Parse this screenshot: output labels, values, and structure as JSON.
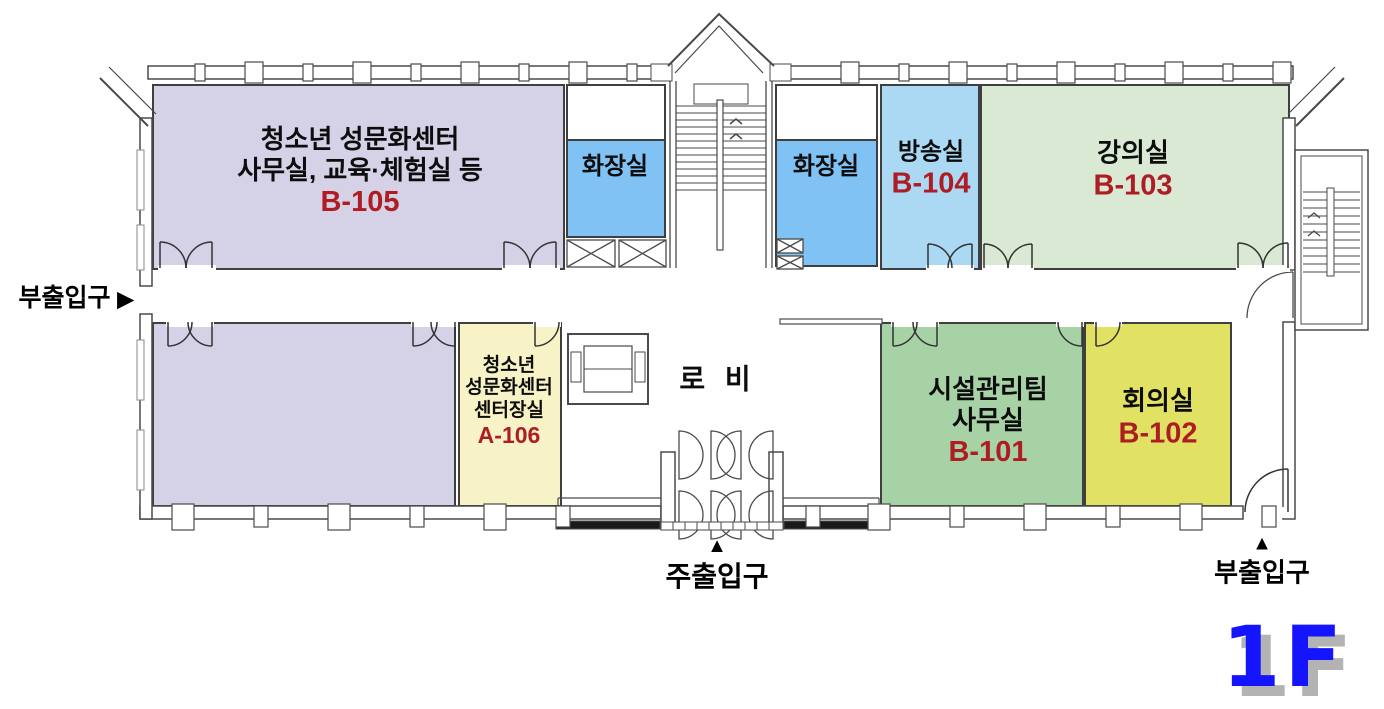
{
  "floor": {
    "label": "1F"
  },
  "rooms": {
    "b105": {
      "line1": "청소년 성문화센터",
      "line2": "사무실, 교육·체험실 등",
      "number": "B-105"
    },
    "toilet_left": {
      "name": "화장실"
    },
    "toilet_right": {
      "name": "화장실"
    },
    "b104": {
      "name": "방송실",
      "number": "B-104"
    },
    "b103": {
      "name": "강의실",
      "number": "B-103"
    },
    "a106": {
      "line1": "청소년",
      "line2": "성문화센터",
      "line3": "센터장실",
      "number": "A-106"
    },
    "lobby": {
      "name": "로 비"
    },
    "b101": {
      "line1": "시설관리팀",
      "line2": "사무실",
      "number": "B-101"
    },
    "b102": {
      "name": "회의실",
      "number": "B-102"
    }
  },
  "entrances": {
    "left": {
      "label": "부출입구",
      "arrow": "▶"
    },
    "main": {
      "label": "주출입구",
      "arrow": "▲"
    },
    "right": {
      "label": "부출입구",
      "arrow": "▲"
    }
  },
  "colors": {
    "room_b105": "#d5d1e7",
    "room_toilet": "#7fc2f3",
    "room_b104": "#abd9f4",
    "room_b103": "#d9e9d4",
    "room_a106": "#f7f3c6",
    "room_b101": "#a7d2a6",
    "room_b102": "#e1e164",
    "room_number_text": "#ae1d23",
    "floor_tag_text": "#1414ff",
    "wall_line": "#4a4a4a"
  }
}
